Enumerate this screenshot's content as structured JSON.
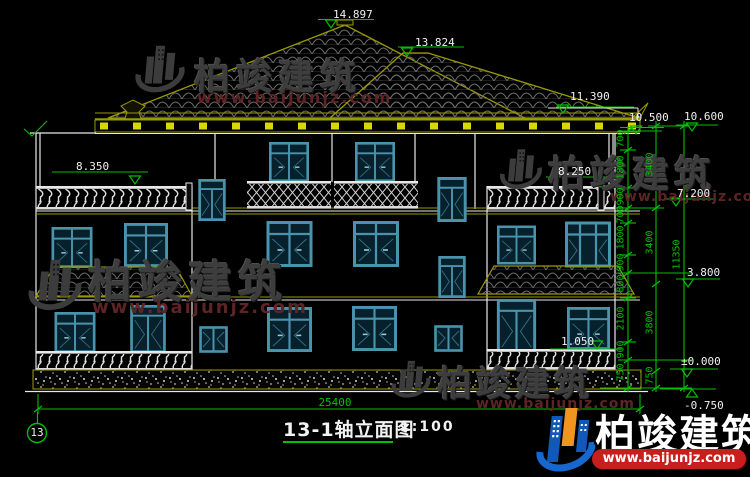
{
  "drawing": {
    "title": "13-1轴立面图",
    "scale": "1:100",
    "axis_label": "13",
    "overall_width_dim": "25400",
    "elevations": {
      "roof_apex": "14.897",
      "roof_secondary": "13.824",
      "upper_eave": "11.390",
      "main_eave_inner": "10.500",
      "main_eave_outer": "10.600",
      "left_parapet": "8.350",
      "right_parapet": "8.250",
      "level_7200": "7.200",
      "level_3800": "3.800",
      "porch_rail": "1.050",
      "ground": "±0.000",
      "site": "-0.750"
    },
    "dim_inner": [
      "700",
      "1800",
      "900",
      "700",
      "1800",
      "900",
      "800",
      "2100",
      "900",
      "750"
    ],
    "dim_mid": [
      "3400",
      "3400",
      "3800",
      "750"
    ],
    "dim_outer": [
      "11350"
    ]
  },
  "watermark": {
    "brand": "柏竣建筑",
    "url": "www.baijunjz.com"
  },
  "footer_logo": {
    "brand": "柏竣建筑",
    "url": "www.baijunjz.com"
  },
  "colors": {
    "background": "#000000",
    "dimension_green": "#00c000",
    "outline_white": "#e8e8e8",
    "roof_olive": "#9a9a00",
    "window_teal": "#4a93ad",
    "dentil_yellow": "#d8d800",
    "logo_blue": "#1464c8",
    "logo_orange": "#f0961e",
    "logo_red": "#c81e1e"
  }
}
